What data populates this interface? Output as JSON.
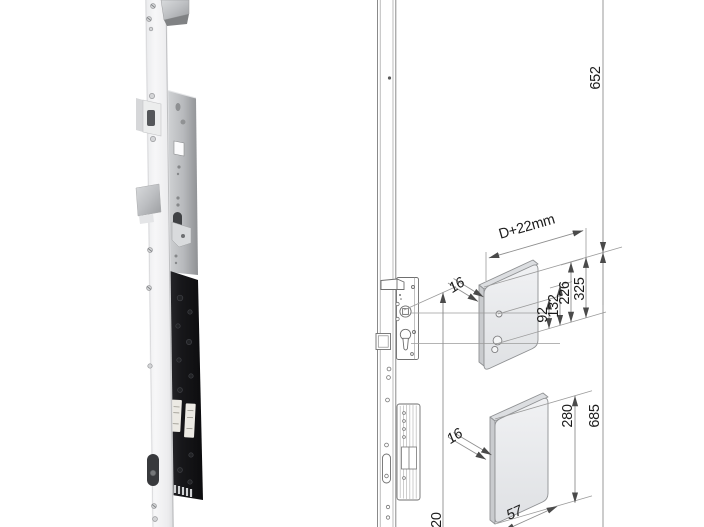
{
  "diagram": {
    "dimensions": {
      "height_top": "652",
      "height_bottom": "685",
      "backset": "D+22mm",
      "spacing_92": "92",
      "spacing_132": "132",
      "spacing_226": "226",
      "spacing_325": "325",
      "plate_height": "280",
      "plate_width": "57",
      "plate_thickness_upper": "16",
      "plate_thickness_lower": "16",
      "height_cut": "020"
    },
    "colors": {
      "background": "#ffffff",
      "dimension_line": "#8f8f8f",
      "drawing_line": "#6f6f6f",
      "text": "#1c1c1c",
      "plate_fill": "#e9ebee",
      "lock_case": "#141417"
    }
  }
}
